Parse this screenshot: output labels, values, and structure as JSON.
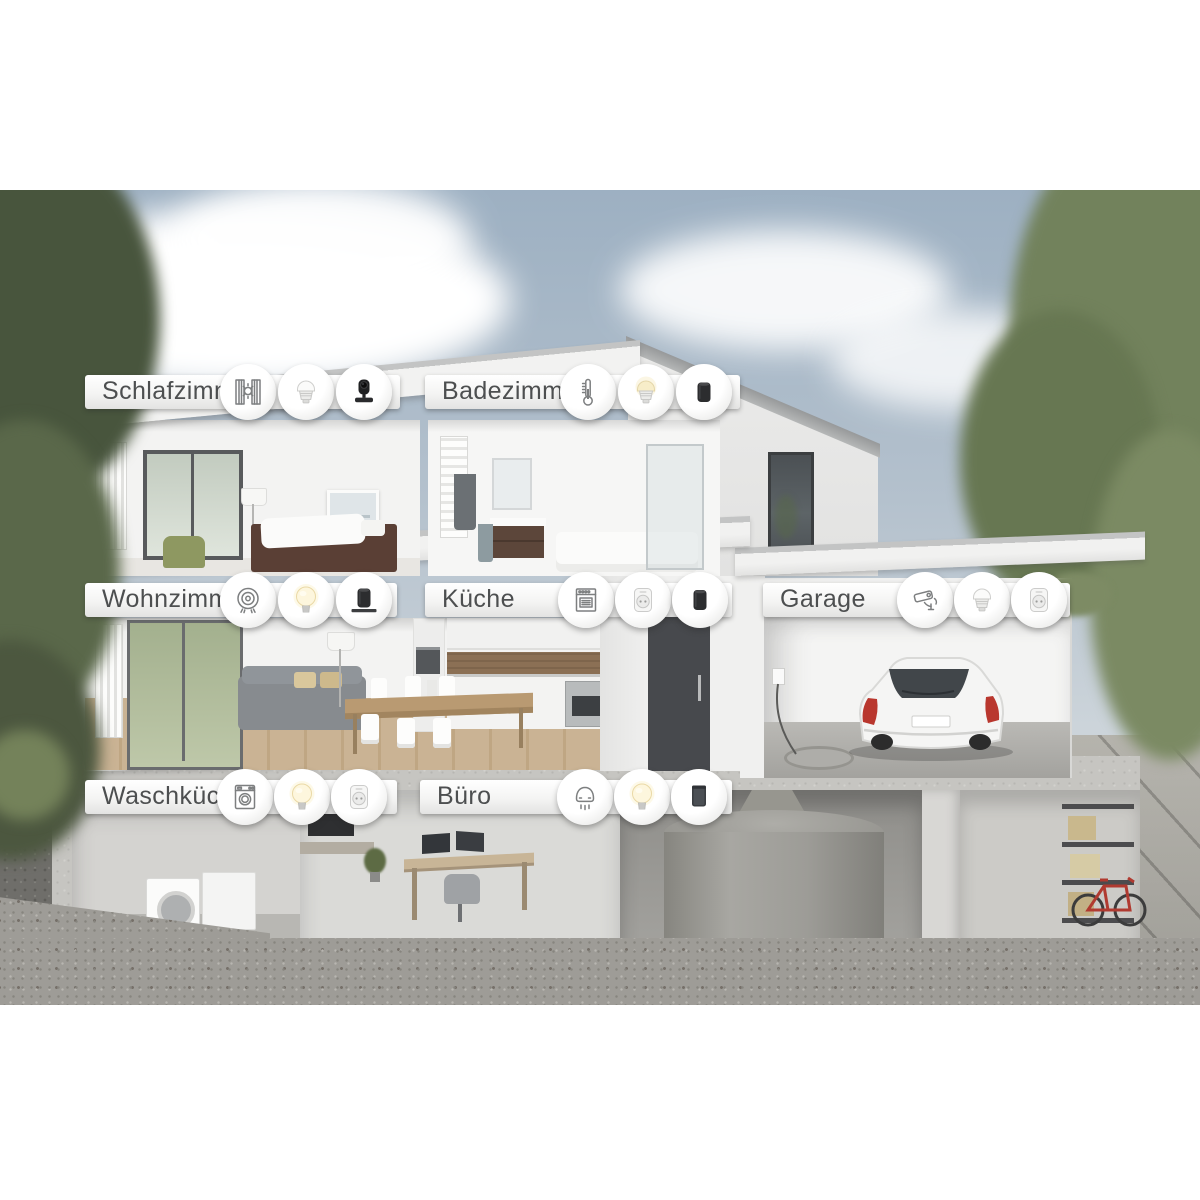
{
  "rooms": [
    {
      "label": "Schlafzimmer",
      "icons": [
        "window-blinds-sun-icon",
        "gu10-spot-bulb-white",
        "smart-camera-black"
      ]
    },
    {
      "label": "Badezimmer",
      "icons": [
        "thermometer-icon",
        "gu10-spot-bulb-warm",
        "speaker-black-cylinder"
      ]
    },
    {
      "label": "Wohnzimmer",
      "icons": [
        "robot-vacuum-icon",
        "e27-bulb-lit",
        "speaker-black-cylinder-on-shelf"
      ]
    },
    {
      "label": "Küche",
      "icons": [
        "oven-icon",
        "smart-plug-white",
        "speaker-black-cylinder"
      ]
    },
    {
      "label": "Garage",
      "icons": [
        "security-camera-icon",
        "gu10-spot-bulb-white",
        "smart-plug-white"
      ]
    },
    {
      "label": "Waschküche",
      "icons": [
        "washing-machine-icon",
        "e27-bulb-lit",
        "smart-plug-white"
      ]
    },
    {
      "label": "Büro",
      "icons": [
        "smoke-detector-icon",
        "e27-bulb-lit",
        "speaker-black-box"
      ]
    }
  ],
  "colors": {
    "sky": "#a9b9c8",
    "foliage": "#75855f",
    "label_text": "#4d4f50",
    "warm_light": "#f7edc9",
    "car_taillight": "#b9372e",
    "concrete": "#c6c5c1"
  }
}
